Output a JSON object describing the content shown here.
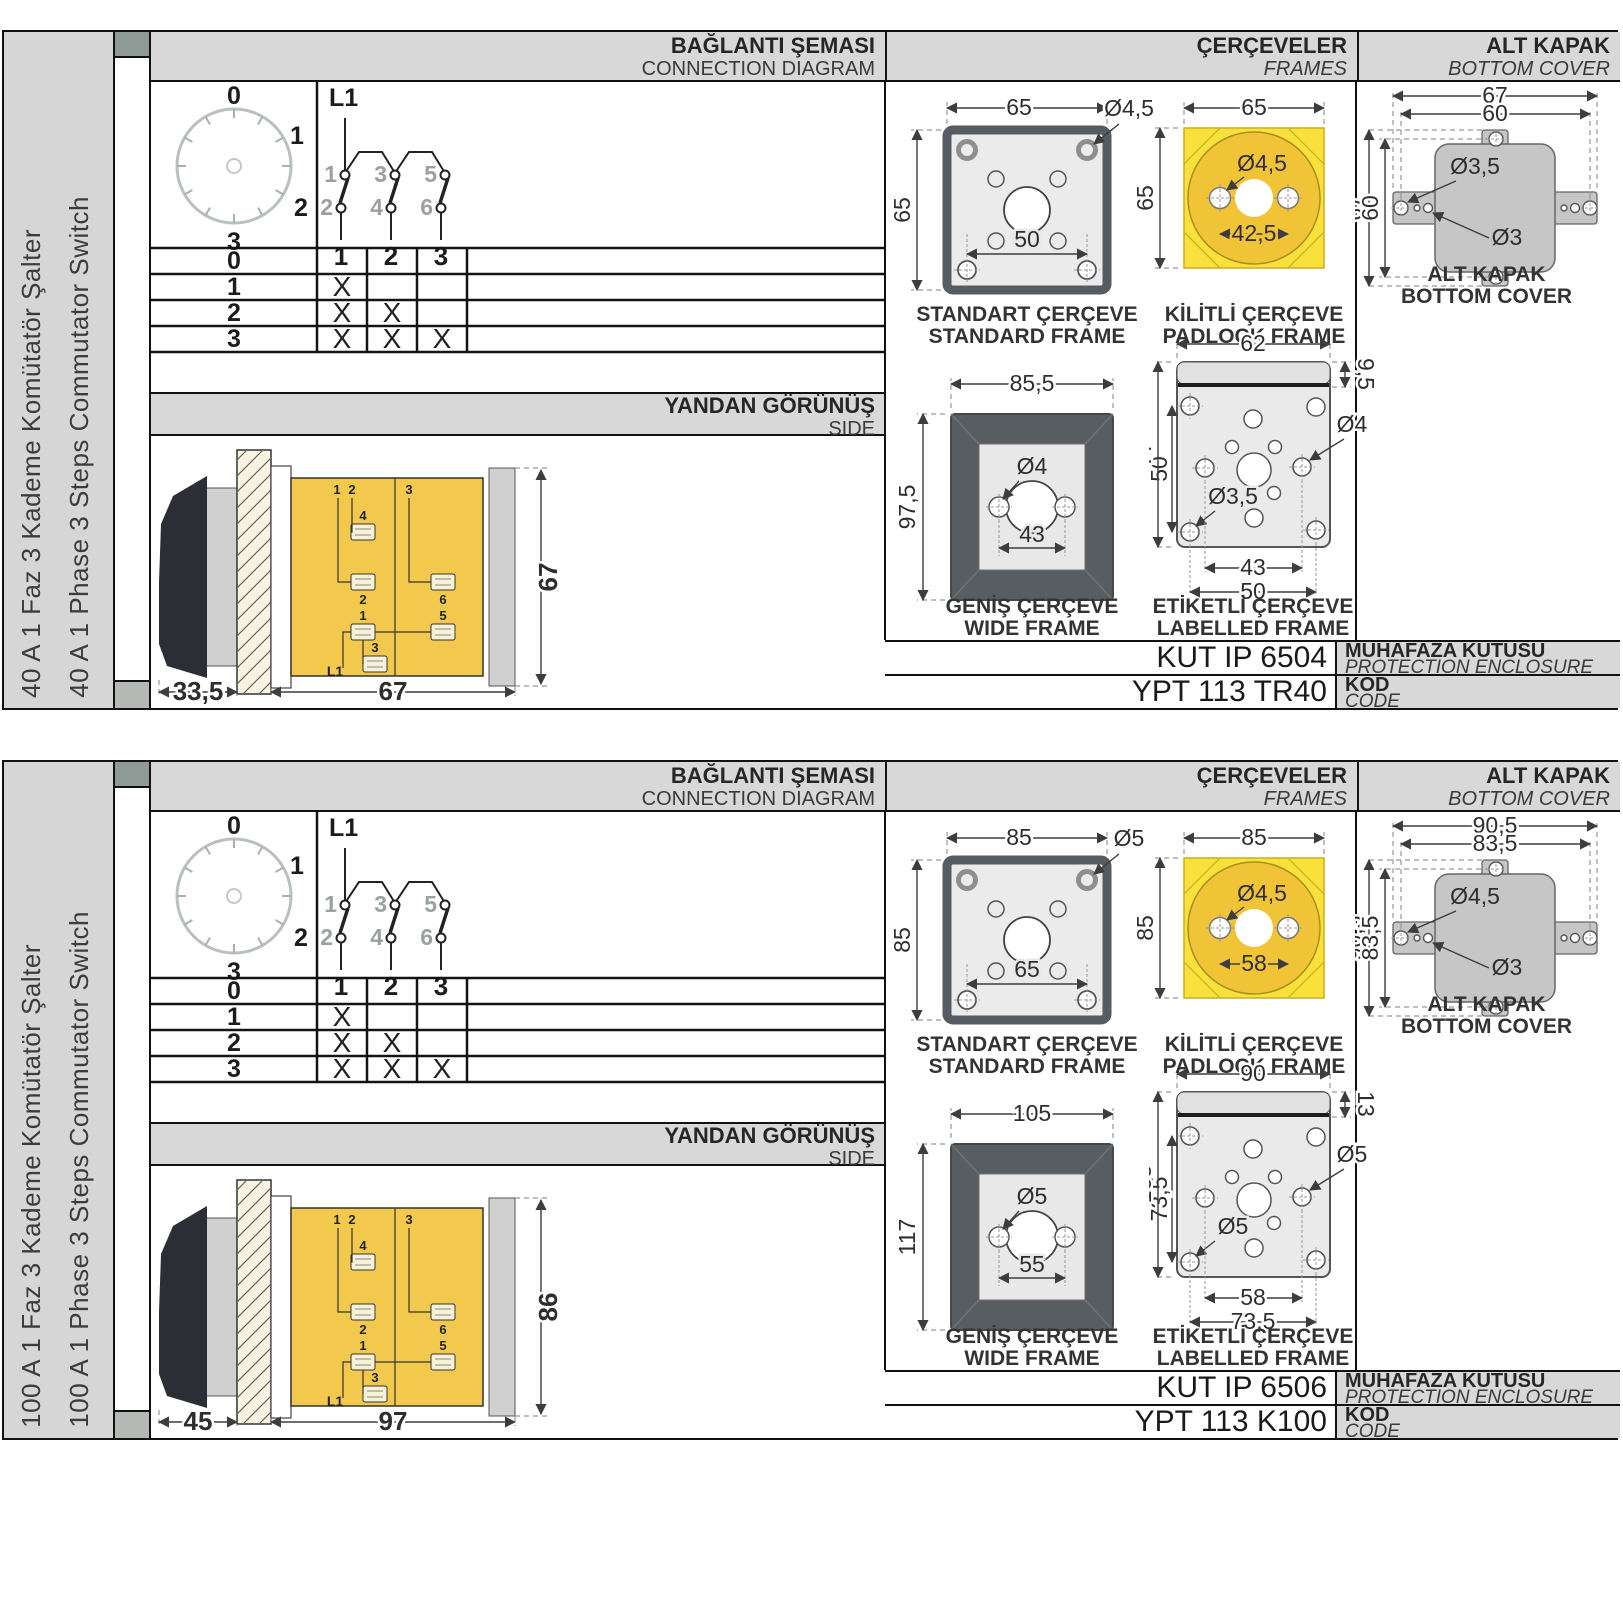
{
  "sections": [
    {
      "sidebar": {
        "line_tr": "40 A 1 Faz 3 Kademe Komütatör Şalter",
        "line_en": "40 A 1 Phase 3 Steps Commutator Switch"
      },
      "headers": {
        "connection_tr": "BAĞLANTI ŞEMASI",
        "connection_en": "CONNECTION DIAGRAM",
        "frames_tr": "ÇERÇEVELER",
        "frames_en": "FRAMES",
        "cover_tr": "ALT KAPAK",
        "cover_en": "BOTTOM COVER",
        "side_tr": "YANDAN GÖRÜNÜŞ",
        "side_en": "SIDE"
      },
      "dial": {
        "p0": "0",
        "p1": "1",
        "p2": "2",
        "p3": "3"
      },
      "circuit": {
        "phase": "L1",
        "c1": "1",
        "c2": "2",
        "c3": "3",
        "c4": "4",
        "c5": "5",
        "c6": "6",
        "o1": "1",
        "o2": "2",
        "o3": "3"
      },
      "table": {
        "rows": [
          {
            "label": "0",
            "marks": [
              "",
              "",
              ""
            ]
          },
          {
            "label": "1",
            "marks": [
              "X",
              "",
              ""
            ]
          },
          {
            "label": "2",
            "marks": [
              "X",
              "X",
              ""
            ]
          },
          {
            "label": "3",
            "marks": [
              "X",
              "X",
              "X"
            ]
          }
        ]
      },
      "side_view": {
        "depth": "33,5",
        "width": "67",
        "height": "67",
        "terminals": {
          "top1": "1",
          "top2": "2",
          "top3": "3",
          "mid4": "4",
          "mid2": "2",
          "mid6": "6",
          "low1": "1",
          "low5": "5",
          "low3": "3",
          "phase": "L1"
        }
      },
      "frames": {
        "standard": {
          "title_tr": "STANDART ÇERÇEVE",
          "title_en": "STANDARD FRAME",
          "width": "65",
          "height": "65",
          "hole": "Ø4,5",
          "inner": "50"
        },
        "padlock": {
          "title_tr": "KİLİTLİ ÇERÇEVE",
          "title_en": "PADLOCK FRAME",
          "width": "65",
          "height": "65",
          "hole": "Ø4,5",
          "inner": "42,5"
        },
        "wide": {
          "title_tr": "GENİŞ ÇERÇEVE",
          "title_en": "WIDE FRAME",
          "width": "85,5",
          "height": "97,5",
          "hole": "Ø4",
          "inner": "43"
        },
        "labelled": {
          "title_tr": "ETİKETLİ ÇERÇEVE",
          "title_en": "LABELLED FRAME",
          "width": "62",
          "strip": "9,5",
          "height": "77",
          "inner_height": "50",
          "hole_big": "Ø4",
          "hole_small": "Ø3,5",
          "span_inner": "43",
          "span_outer": "50"
        }
      },
      "cover": {
        "title_tr": "ALT KAPAK",
        "title_en": "BOTTOM COVER",
        "outer_w": "67",
        "inner_w": "60",
        "outer_h": "67",
        "inner_h": "60",
        "hole_big": "Ø3,5",
        "hole_small": "Ø3"
      },
      "enclosure": {
        "code": "KUT IP 6504",
        "label_tr": "MUHAFAZA KUTUSU",
        "label_en": "PROTECTION ENCLOSURE"
      },
      "code": {
        "value": "YPT 113 TR40",
        "label_tr": "KOD",
        "label_en": "CODE"
      }
    },
    {
      "sidebar": {
        "line_tr": "100 A 1 Faz 3 Kademe Komütatör Şalter",
        "line_en": "100 A 1 Phase 3 Steps Commutator Switch"
      },
      "headers": {
        "connection_tr": "BAĞLANTI ŞEMASI",
        "connection_en": "CONNECTION DIAGRAM",
        "frames_tr": "ÇERÇEVELER",
        "frames_en": "FRAMES",
        "cover_tr": "ALT KAPAK",
        "cover_en": "BOTTOM COVER",
        "side_tr": "YANDAN GÖRÜNÜŞ",
        "side_en": "SIDE"
      },
      "dial": {
        "p0": "0",
        "p1": "1",
        "p2": "2",
        "p3": "3"
      },
      "circuit": {
        "phase": "L1",
        "c1": "1",
        "c2": "2",
        "c3": "3",
        "c4": "4",
        "c5": "5",
        "c6": "6",
        "o1": "1",
        "o2": "2",
        "o3": "3"
      },
      "table": {
        "rows": [
          {
            "label": "0",
            "marks": [
              "",
              "",
              ""
            ]
          },
          {
            "label": "1",
            "marks": [
              "X",
              "",
              ""
            ]
          },
          {
            "label": "2",
            "marks": [
              "X",
              "X",
              ""
            ]
          },
          {
            "label": "3",
            "marks": [
              "X",
              "X",
              "X"
            ]
          }
        ]
      },
      "side_view": {
        "depth": "45",
        "width": "97",
        "height": "86",
        "terminals": {
          "top1": "1",
          "top2": "2",
          "top3": "3",
          "mid4": "4",
          "mid2": "2",
          "mid6": "6",
          "low1": "1",
          "low5": "5",
          "low3": "3",
          "phase": "L1"
        }
      },
      "frames": {
        "standard": {
          "title_tr": "STANDART ÇERÇEVE",
          "title_en": "STANDARD FRAME",
          "width": "85",
          "height": "85",
          "hole": "Ø5",
          "inner": "65"
        },
        "padlock": {
          "title_tr": "KİLİTLİ ÇERÇEVE",
          "title_en": "PADLOCK FRAME",
          "width": "85",
          "height": "85",
          "hole": "Ø4,5",
          "inner": "58"
        },
        "wide": {
          "title_tr": "GENİŞ ÇERÇEVE",
          "title_en": "WIDE FRAME",
          "width": "105",
          "height": "117",
          "hole": "Ø5",
          "inner": "55"
        },
        "labelled": {
          "title_tr": "ETİKETLİ ÇERÇEVE",
          "title_en": "LABELLED FRAME",
          "width": "90",
          "strip": "13",
          "height": "105",
          "inner_height": "73,5",
          "hole_big": "Ø5",
          "hole_small": "Ø5",
          "span_inner": "58",
          "span_outer": "73,5"
        }
      },
      "cover": {
        "title_tr": "ALT KAPAK",
        "title_en": "BOTTOM COVER",
        "outer_w": "90,5",
        "inner_w": "83,5",
        "outer_h": "90,5",
        "inner_h": "83,5",
        "hole_big": "Ø4,5",
        "hole_small": "Ø3"
      },
      "enclosure": {
        "code": "KUT IP 6506",
        "label_tr": "MUHAFAZA KUTUSU",
        "label_en": "PROTECTION ENCLOSURE"
      },
      "code": {
        "value": "YPT 113 K100",
        "label_tr": "KOD",
        "label_en": "CODE"
      }
    }
  ]
}
